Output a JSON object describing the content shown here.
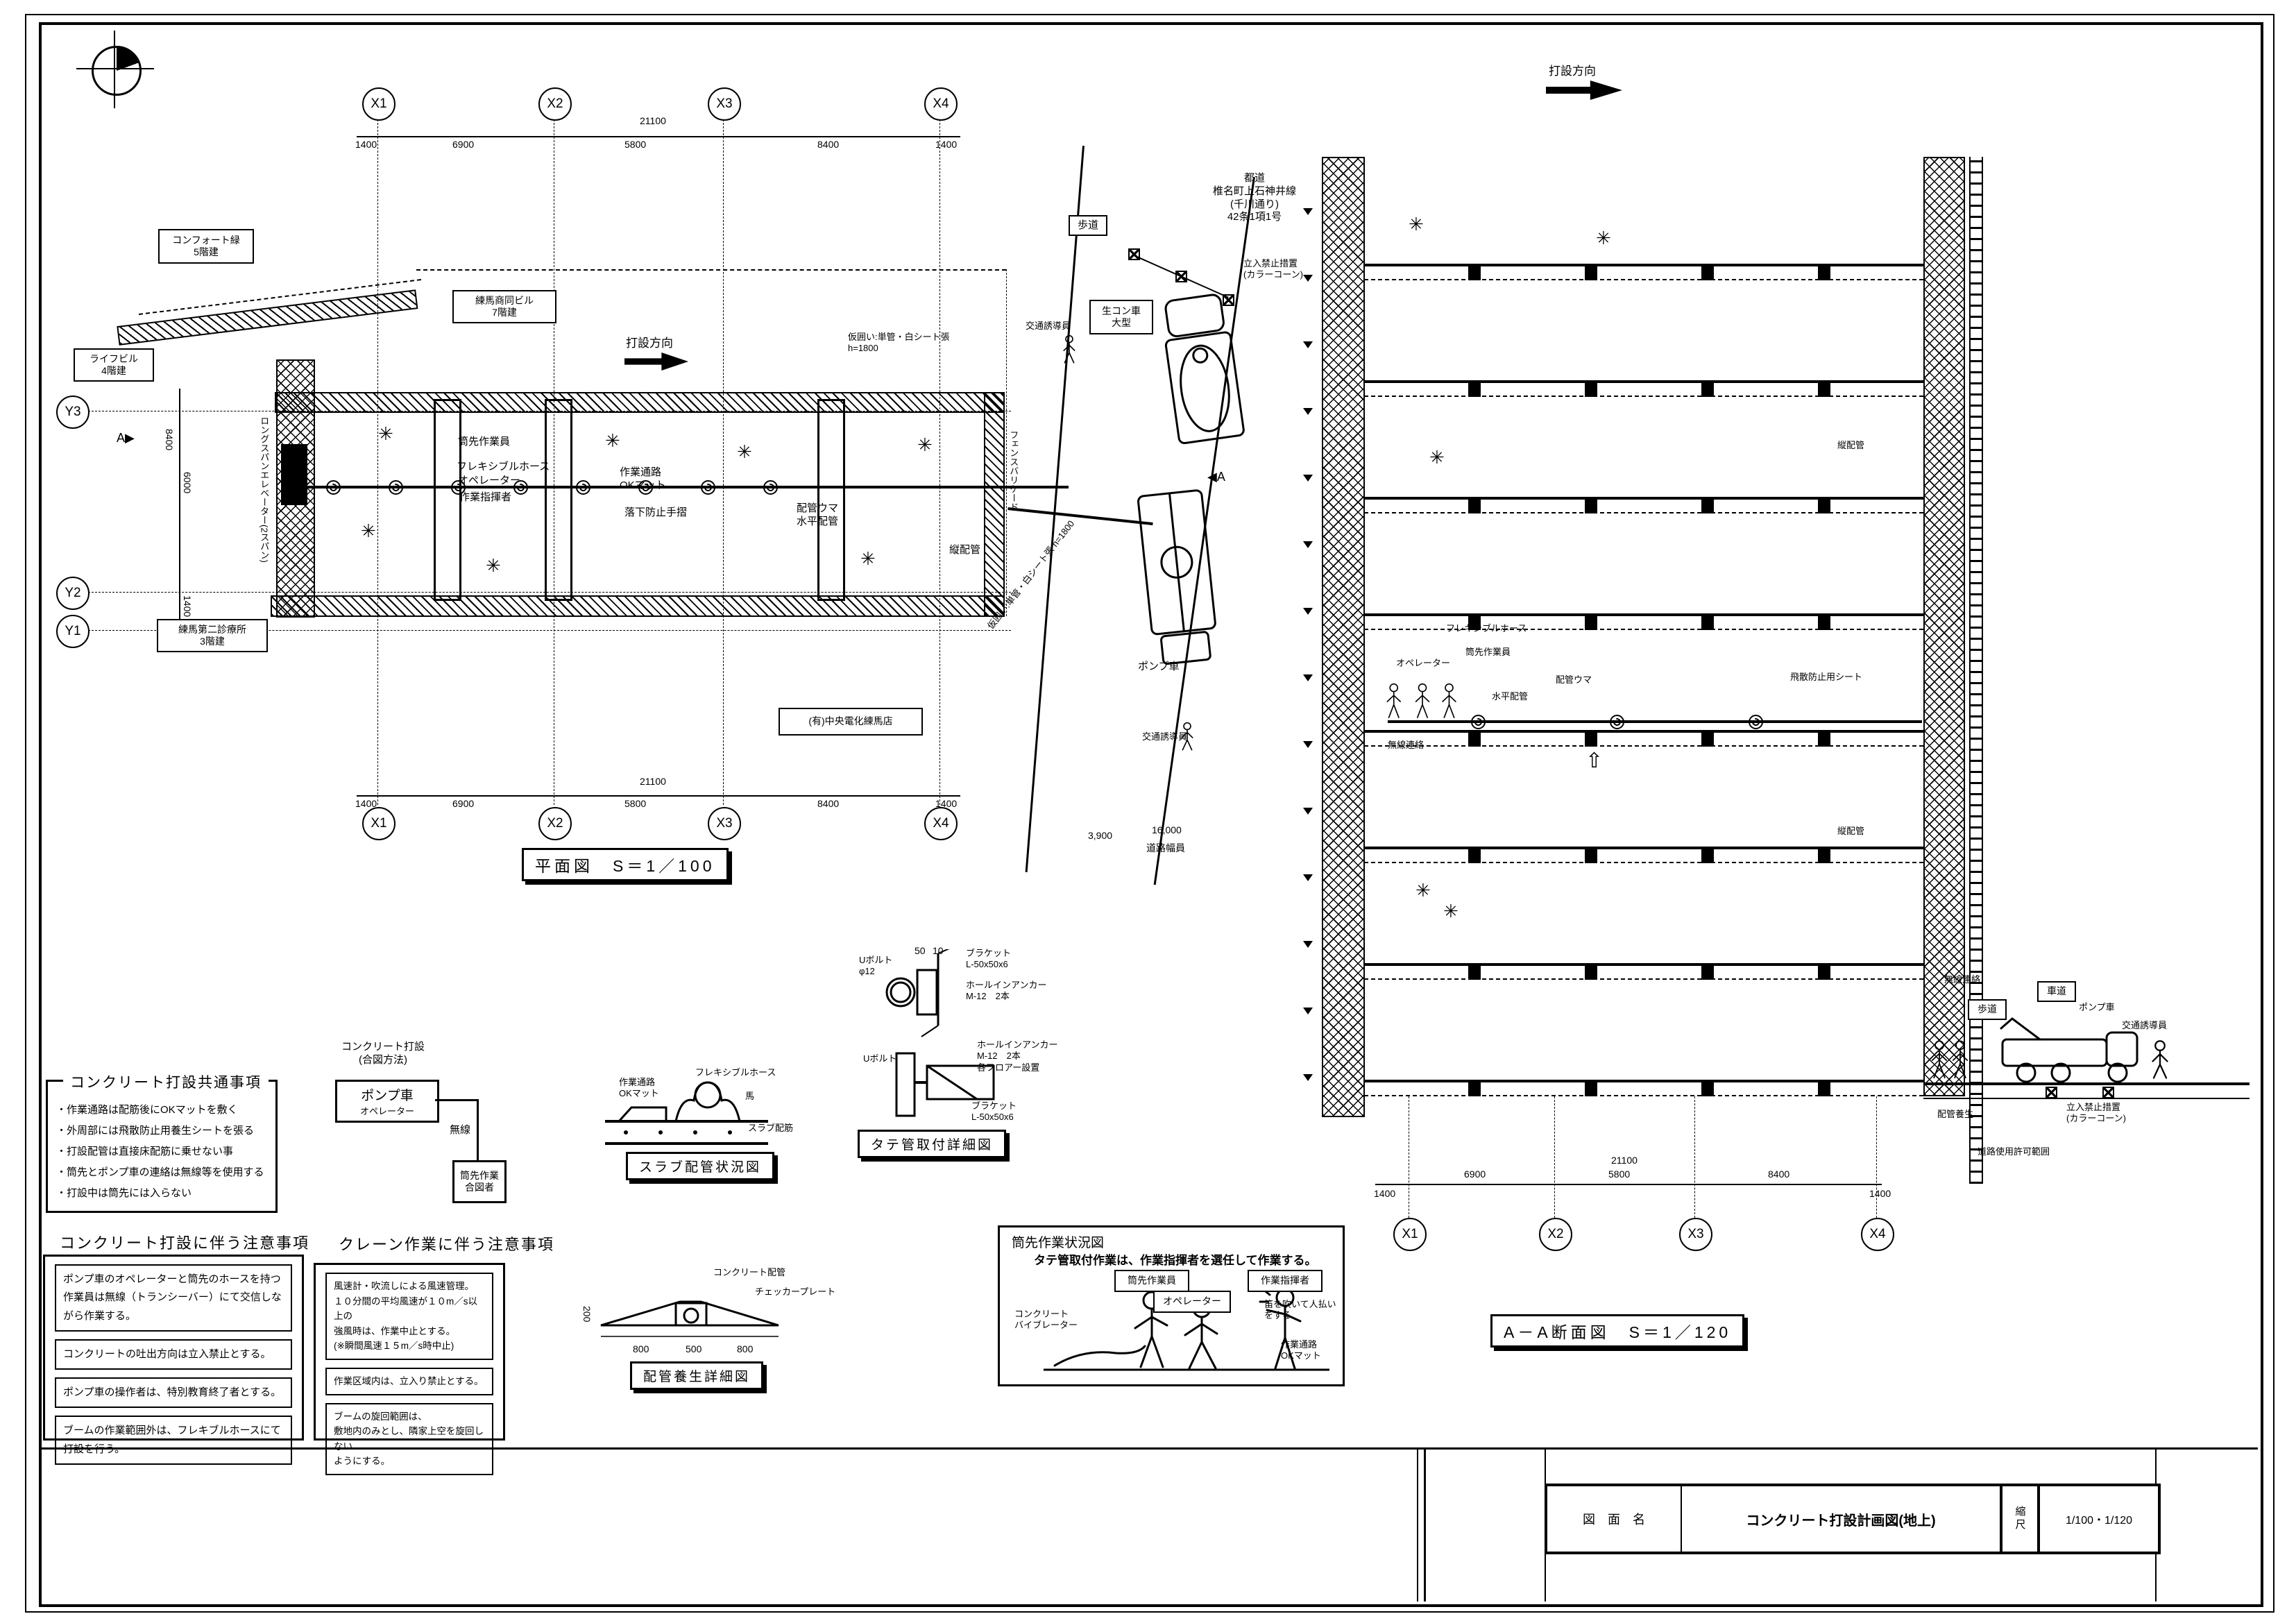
{
  "title_block": {
    "label": "図　面　名",
    "name": "コンクリート打設計画図(地上)",
    "scale_label": "縮尺",
    "scale": "1/100・1/120"
  },
  "plan": {
    "title": "平面図　S＝1／100",
    "direction_label": "打設方向",
    "grid_x": [
      "X1",
      "X2",
      "X3",
      "X4"
    ],
    "grid_y": [
      "Y3",
      "Y2",
      "Y1"
    ],
    "dims_top": {
      "overall": "21100",
      "left_end": "1400",
      "x1x2": "6900",
      "x2x3": "5800",
      "x3x4": "8400",
      "right_end": "1400"
    },
    "dims_left": [
      "8400",
      "6000",
      "1400"
    ],
    "buildings": {
      "comfort": "コンフォート緑\n5階建",
      "life": "ライフビル\n4階建",
      "nerima": "練馬商同ビル\n7階建",
      "clinic": "練馬第二診療所\n3階建",
      "denka": "(有)中央電化練馬店"
    },
    "labels": {
      "nozzle_worker": "筒先作業員",
      "flex_hose": "フレキシブルホース",
      "operator": "オペレーター",
      "supervisor": "作業指揮者",
      "walkway": "作業通路\nOKマット",
      "handrail": "落下防止手摺",
      "pipe_horse": "配管ウマ\n水平配管",
      "riser": "縦配管",
      "fence_top": "仮囲い:単管・白シート張\nh=1800",
      "fence_road": "仮囲い:単管・白シート張 h=1800",
      "fence_barricade": "フェンスバリケード",
      "longspan": "ロングスパンエレベーター(2スパン)",
      "section_mark": "A"
    }
  },
  "road": {
    "sidewalk": "歩道",
    "route": "都道\n椎名町上石神井線\n(千川通り)\n42条1項1号",
    "no_entry": "立入禁止措置\n(カラーコーン)",
    "mixer": "生コン車\n大型",
    "guard1": "交通誘導員",
    "guard2": "交通誘導員",
    "pump": "ポンプ車",
    "dim_sidewalk": "3,900",
    "dim_road": "16,000",
    "road_width_label": "道路幅員"
  },
  "section": {
    "title": "A－A断面図　S＝1／120",
    "direction_label": "打設方向",
    "labels": {
      "flex_hose": "フレキシブルホース",
      "nozzle_worker": "筒先作業員",
      "operator": "オペレーター",
      "pipe_horse": "配管ウマ",
      "horizontal_pipe": "水平配管",
      "scatter_sheet": "飛散防止用シート",
      "wireless1": "無線連絡",
      "riser1": "縦配管",
      "riser2": "縦配管",
      "wireless2": "無線連絡",
      "sidewalk": "歩道",
      "roadway": "車道",
      "pump": "ポンプ車",
      "guard": "交通誘導員",
      "pipe_protect": "配管養生",
      "no_entry": "立入禁止措置\n(カラーコーン)",
      "road_use": "道路使用許可範囲"
    },
    "grid_x": [
      "X1",
      "X2",
      "X3",
      "X4"
    ],
    "dims_bottom": {
      "overall": "21100",
      "left_end": "1400",
      "x1x2": "6900",
      "x2x3": "5800",
      "x3x4": "8400",
      "right_end": "1400"
    }
  },
  "signal": {
    "heading": "コンクリート打設\n(合図方法)",
    "pump_main": "ポンプ車",
    "pump_sub": "オペレーター",
    "link": "無線",
    "nozzle": "筒先作業\n合図者"
  },
  "notes_common": {
    "title": "コンクリート打設共通事項",
    "items": [
      "・作業通路は配筋後にOKマットを敷く",
      "・外周部には飛散防止用養生シートを張る",
      "・打設配管は直接床配筋に乗せない事",
      "・筒先とポンプ車の連絡は無線等を使用する",
      "・打設中は筒先には入らない"
    ]
  },
  "notes_pour": {
    "title": "コンクリート打設に伴う注意事項",
    "boxes": [
      "ポンプ車のオペレーターと筒先のホースを持つ\n作業員は無線（トランシーバー）にて交信しな\nがら作業する。",
      "コンクリートの吐出方向は立入禁止とする。",
      "ポンプ車の操作者は、特別教育終了者とする。",
      "ブームの作業範囲外は、フレキブルホースにて\n打設を行う。"
    ]
  },
  "notes_crane": {
    "title": "クレーン作業に伴う注意事項",
    "boxes": [
      "風速計・吹流しによる風速管理。\n１０分間の平均風速が１０m／s以上の\n強風時は、作業中止とする。\n(※瞬間風速１５m／s時中止)",
      "作業区域内は、立入り禁止とする。",
      "ブームの旋回範囲は、\n敷地内のみとし、隣家上空を旋回しない\nようにする。"
    ]
  },
  "details": {
    "slab_piping": {
      "title": "スラブ配管状況図",
      "walkway": "作業通路\nOKマット",
      "flex_hose": "フレキシブルホース",
      "horse": "馬",
      "slab_rebar": "スラブ配筋"
    },
    "riser_mount": {
      "title": "タテ管取付詳細図",
      "ubolt": "Uボルト\nφ12",
      "dim50": "50",
      "dim10": "10",
      "bracket": "ブラケット\nL-50x50x6",
      "anchor": "ホールインアンカー\nM-12　2本",
      "ubolt_lower": "Uボルト",
      "anchor_lower": "ホールインアンカー\nM-12　2本\n各フロアー設置",
      "bracket_lower": "ブラケット\nL-50x50x6"
    },
    "pipe_protection": {
      "title": "配管養生詳細図",
      "concrete_pipe": "コンクリート配管",
      "checker_plate": "チェッカープレート",
      "dim_h": "200",
      "dim_a": "800",
      "dim_b": "500",
      "dim_c": "800"
    },
    "nozzle_work": {
      "title": "筒先作業状況図",
      "subtitle": "タテ管取付作業は、作業指揮者を選任して作業する。",
      "nozzle_worker": "筒先作業員",
      "operator": "オペレーター",
      "supervisor": "作業指揮者",
      "whistle": "笛を吹いて人払いをする",
      "vibrator": "コンクリート\nバイブレーター",
      "walkway": "作業通路\nOKマット"
    }
  }
}
